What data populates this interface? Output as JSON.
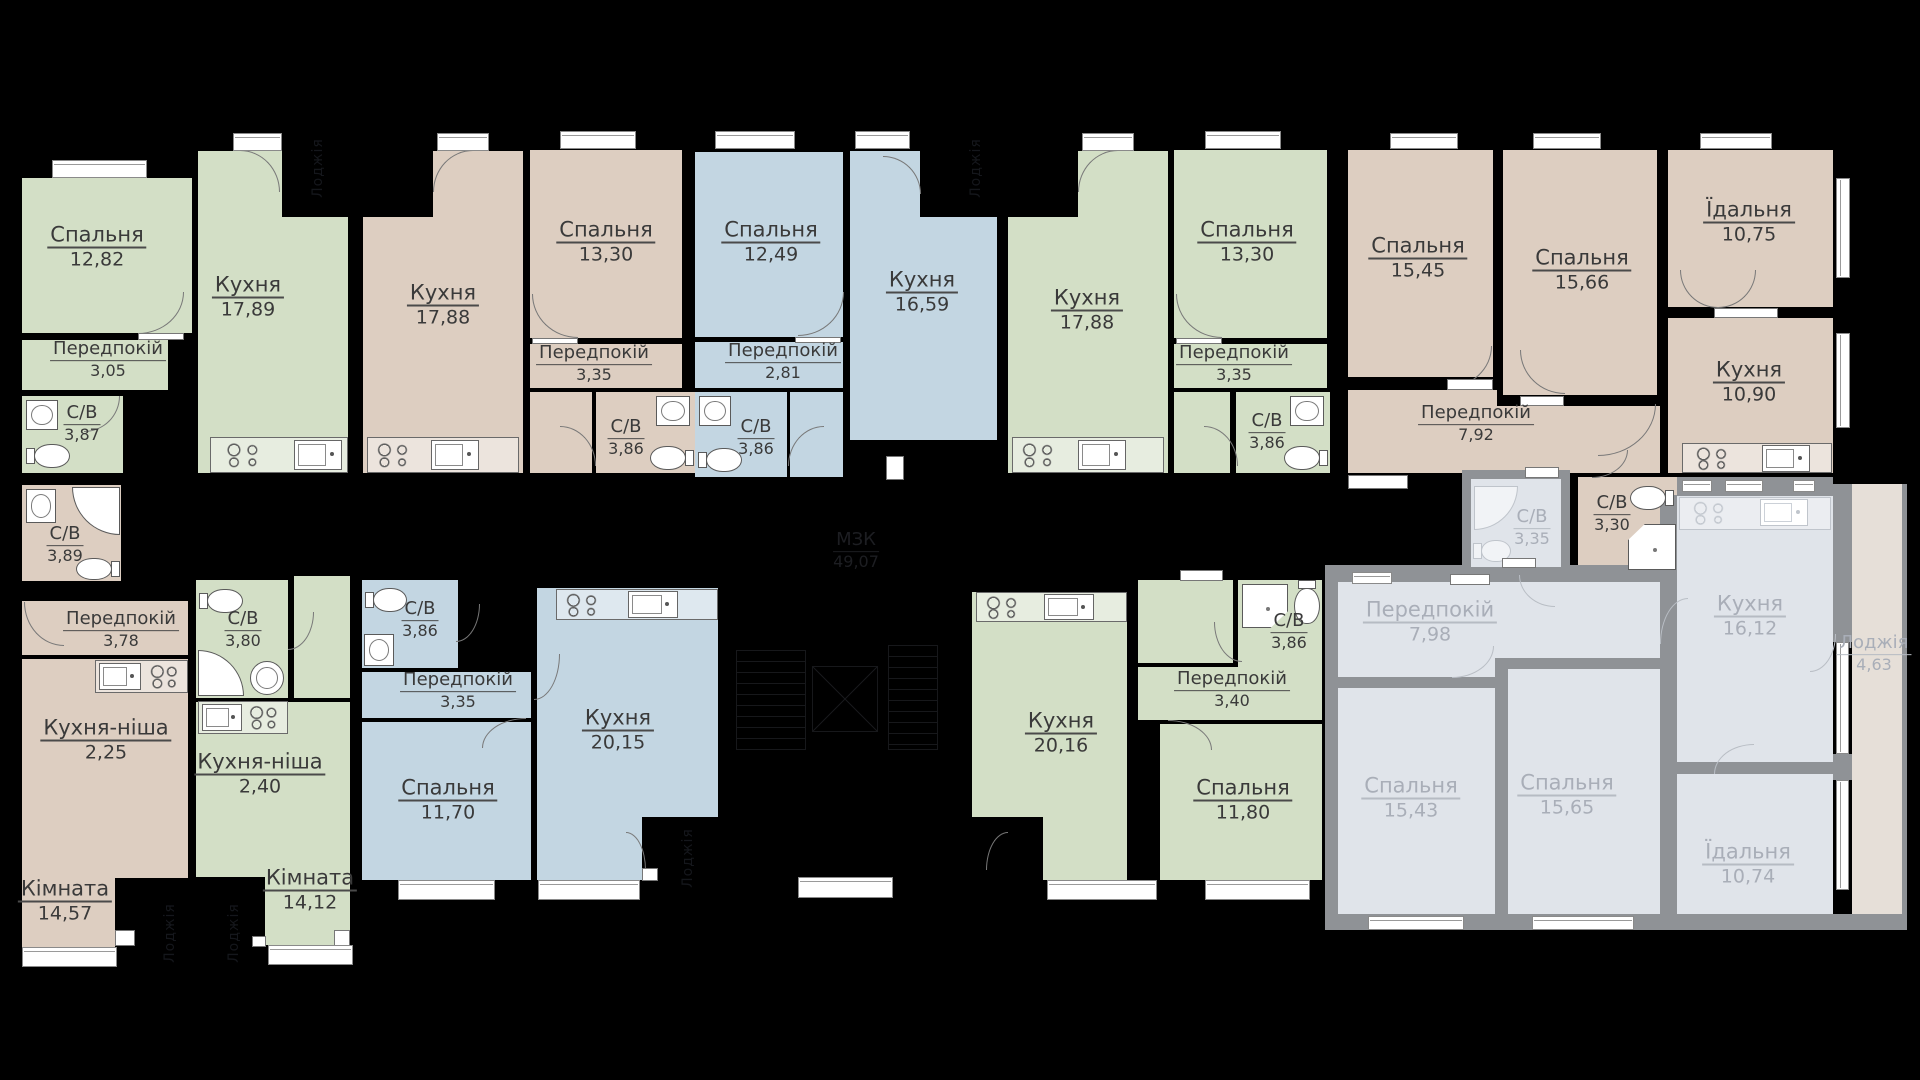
{
  "core": {
    "name": "МЗК",
    "area": "49,07"
  },
  "labels": {
    "balcony": "Лоджія"
  },
  "colors": {
    "background": "#000000",
    "active_green": "#d3dfc6",
    "active_beige": "#ddcec1",
    "active_blue": "#c3d6e2",
    "inactive_fill": "#e0e4ea",
    "inactive_wall": "#8f9296",
    "inactive_text": "#a9aeb8",
    "loggia_fill": "#e6dfd8",
    "window": "#ffffff",
    "label_text": "#3a3a3a"
  },
  "apartments": [
    {
      "id": "apt-1",
      "status": "active",
      "color": "green",
      "rooms": [
        {
          "name": "Спальня",
          "area": "12,82"
        },
        {
          "name": "Кухня",
          "area": "17,89"
        },
        {
          "name": "Передпокій",
          "area": "3,05"
        },
        {
          "name": "С/В",
          "area": "3,87"
        }
      ]
    },
    {
      "id": "apt-2",
      "status": "active",
      "color": "beige",
      "rooms": [
        {
          "name": "Кухня",
          "area": "17,88"
        },
        {
          "name": "Спальня",
          "area": "13,30"
        },
        {
          "name": "Передпокій",
          "area": "3,35"
        },
        {
          "name": "С/В",
          "area": "3,86"
        }
      ]
    },
    {
      "id": "apt-3",
      "status": "active",
      "color": "blue",
      "rooms": [
        {
          "name": "Спальня",
          "area": "12,49"
        },
        {
          "name": "Кухня",
          "area": "16,59"
        },
        {
          "name": "Передпокій",
          "area": "2,81"
        },
        {
          "name": "С/В",
          "area": "3,86"
        }
      ]
    },
    {
      "id": "apt-4",
      "status": "active",
      "color": "green",
      "rooms": [
        {
          "name": "Кухня",
          "area": "17,88"
        },
        {
          "name": "Спальня",
          "area": "13,30"
        },
        {
          "name": "Передпокій",
          "area": "3,35"
        },
        {
          "name": "С/В",
          "area": "3,86"
        }
      ]
    },
    {
      "id": "apt-5",
      "status": "active",
      "color": "beige",
      "rooms": [
        {
          "name": "Спальня",
          "area": "15,45"
        },
        {
          "name": "Спальня",
          "area": "15,66"
        },
        {
          "name": "Їдальня",
          "area": "10,75"
        },
        {
          "name": "Кухня",
          "area": "10,90"
        },
        {
          "name": "Передпокій",
          "area": "7,92"
        },
        {
          "name": "С/В",
          "area": "3,30"
        }
      ]
    },
    {
      "id": "apt-6",
      "status": "active",
      "color": "beige",
      "rooms": [
        {
          "name": "С/В",
          "area": "3,89"
        },
        {
          "name": "Передпокій",
          "area": "3,78"
        },
        {
          "name": "Кухня-ніша",
          "area": "2,25"
        },
        {
          "name": "Кімната",
          "area": "14,57"
        }
      ]
    },
    {
      "id": "apt-7",
      "status": "active",
      "color": "green",
      "rooms": [
        {
          "name": "С/В",
          "area": "3,80"
        },
        {
          "name": "Кухня-ніша",
          "area": "2,40"
        },
        {
          "name": "Кімната",
          "area": "14,12"
        }
      ]
    },
    {
      "id": "apt-8",
      "status": "active",
      "color": "blue",
      "rooms": [
        {
          "name": "С/В",
          "area": "3,86"
        },
        {
          "name": "Передпокій",
          "area": "3,35"
        },
        {
          "name": "Спальня",
          "area": "11,70"
        },
        {
          "name": "Кухня",
          "area": "20,15"
        }
      ]
    },
    {
      "id": "apt-9",
      "status": "active",
      "color": "green",
      "rooms": [
        {
          "name": "Кухня",
          "area": "20,16"
        },
        {
          "name": "Передпокій",
          "area": "3,40"
        },
        {
          "name": "С/В",
          "area": "3,86"
        },
        {
          "name": "Спальня",
          "area": "11,80"
        }
      ]
    },
    {
      "id": "apt-10",
      "status": "inactive",
      "color": "gray",
      "rooms": [
        {
          "name": "Передпокій",
          "area": "7,98"
        },
        {
          "name": "Кухня",
          "area": "16,12"
        },
        {
          "name": "Спальня",
          "area": "15,43"
        },
        {
          "name": "Спальня",
          "area": "15,65"
        },
        {
          "name": "Їдальня",
          "area": "10,74"
        },
        {
          "name": "Лоджія",
          "area": "4,63"
        },
        {
          "name": "С/В",
          "area": "3,35"
        }
      ]
    }
  ]
}
